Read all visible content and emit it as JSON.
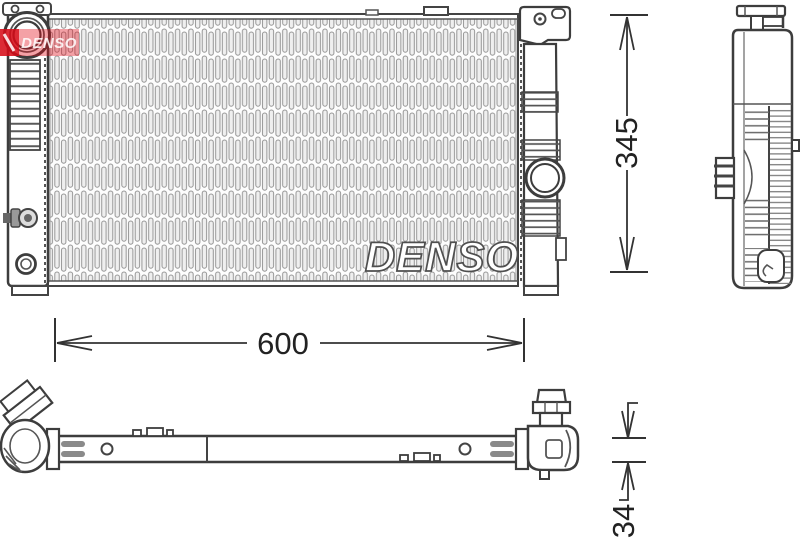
{
  "brand": {
    "logo_text": "DENSO",
    "watermark_text": "DENSO",
    "logo_red": "#e10c17"
  },
  "dimensions": {
    "height_mm": "345",
    "width_mm": "600",
    "depth_mm": "34"
  },
  "colors": {
    "line": "#3d3d3d",
    "fin": "#969696",
    "background": "#ffffff"
  }
}
